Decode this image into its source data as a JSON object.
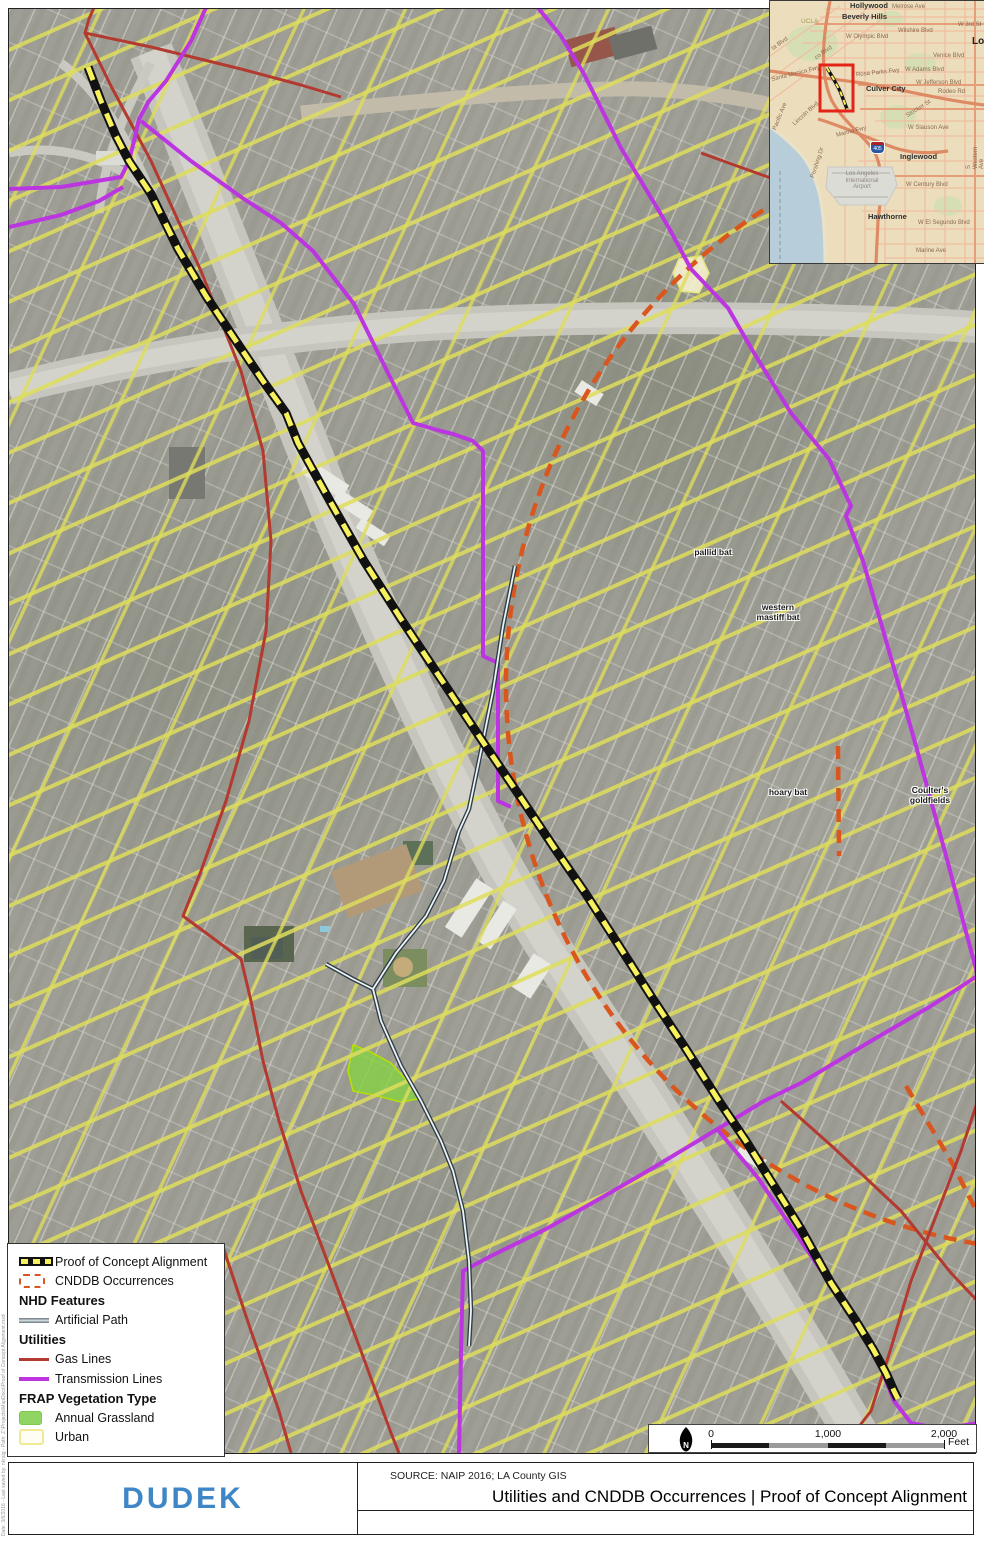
{
  "title_block": {
    "logo": "DUDEK",
    "source": "SOURCE: NAIP 2016; LA County GIS",
    "title": "Utilities and CNDDB Occurrences | Proof of Concept Alignment",
    "edge_note": "Date: 3/6/2018  -  Last saved by: nkraig  -  Path: Z:\\Projects\\MapDocs\\Proof of Concept Alignment.mxd"
  },
  "legend": {
    "items": [
      {
        "label": "Proof of Concept Alignment",
        "swatch": "alignment"
      },
      {
        "label": "CNDDB Occurrences",
        "swatch": "cnddb-dashed-outline"
      },
      {
        "label": "NHD Features",
        "type": "header"
      },
      {
        "label": "Artificial Path",
        "swatch": "gray-double-line"
      },
      {
        "label": "Utilities",
        "type": "header"
      },
      {
        "label": "Gas Lines",
        "swatch": "dark-red-line"
      },
      {
        "label": "Transmission Lines",
        "swatch": "purple-line"
      },
      {
        "label": "FRAP Vegetation Type",
        "type": "header"
      },
      {
        "label": "Annual Grassland",
        "swatch": "green-fill"
      },
      {
        "label": "Urban",
        "swatch": "pale-yellow-outline"
      }
    ]
  },
  "scale_bar": {
    "ticks": [
      "0",
      "1,000",
      "2,000"
    ],
    "unit": "Feet"
  },
  "map": {
    "species_labels": [
      {
        "text": "pallid bat"
      },
      {
        "text": "western\nmastiff bat"
      },
      {
        "text": "hoary bat"
      },
      {
        "text": "Coulter's\ngoldfields"
      }
    ],
    "colors": {
      "alignment_dash": "#f7f15e",
      "alignment_casing": "#111111",
      "cnddb": "#d9561f",
      "gas_line": "#b23a30",
      "transmission_line": "#bb35e0",
      "artificial_path": "#7d8a92",
      "annual_grassland": "#90d464",
      "urban_hatch": "#dedd5c",
      "dudek_blue": "#3f86c6",
      "extent_box_red": "#e32417"
    }
  },
  "inset": {
    "interstate_shield": "405",
    "labels": [
      {
        "text": "Hollywood"
      },
      {
        "text": "Melrose Ave"
      },
      {
        "text": "Beverly Hills"
      },
      {
        "text": "W 3rd St"
      },
      {
        "text": "Wilshire Blvd"
      },
      {
        "text": "Lo"
      },
      {
        "text": "W Olympic Blvd"
      },
      {
        "text": "UCLA"
      },
      {
        "text": "ta Blvd"
      },
      {
        "text": "co Blvd"
      },
      {
        "text": "Venice Blvd"
      },
      {
        "text": "W Adams Blvd"
      },
      {
        "text": "Santa Monica Fwy"
      },
      {
        "text": "Rosa Parks Fwy"
      },
      {
        "text": "W Jefferson Blvd"
      },
      {
        "text": "Rodeo Rd"
      },
      {
        "text": "Culver City"
      },
      {
        "text": "Stocker St"
      },
      {
        "text": "Lincoln Blvd"
      },
      {
        "text": "W Slauson Ave"
      },
      {
        "text": "Marina Fwy"
      },
      {
        "text": "Pacific Ave"
      },
      {
        "text": "Inglewood"
      },
      {
        "text": "S Western Ave"
      },
      {
        "text": "Los Angeles\nInternational\nAirport"
      },
      {
        "text": "W Century Blvd"
      },
      {
        "text": "Pershing Dr"
      },
      {
        "text": "Hawthorne"
      },
      {
        "text": "W El Segundo Blvd"
      },
      {
        "text": "Marine Ave"
      }
    ]
  }
}
